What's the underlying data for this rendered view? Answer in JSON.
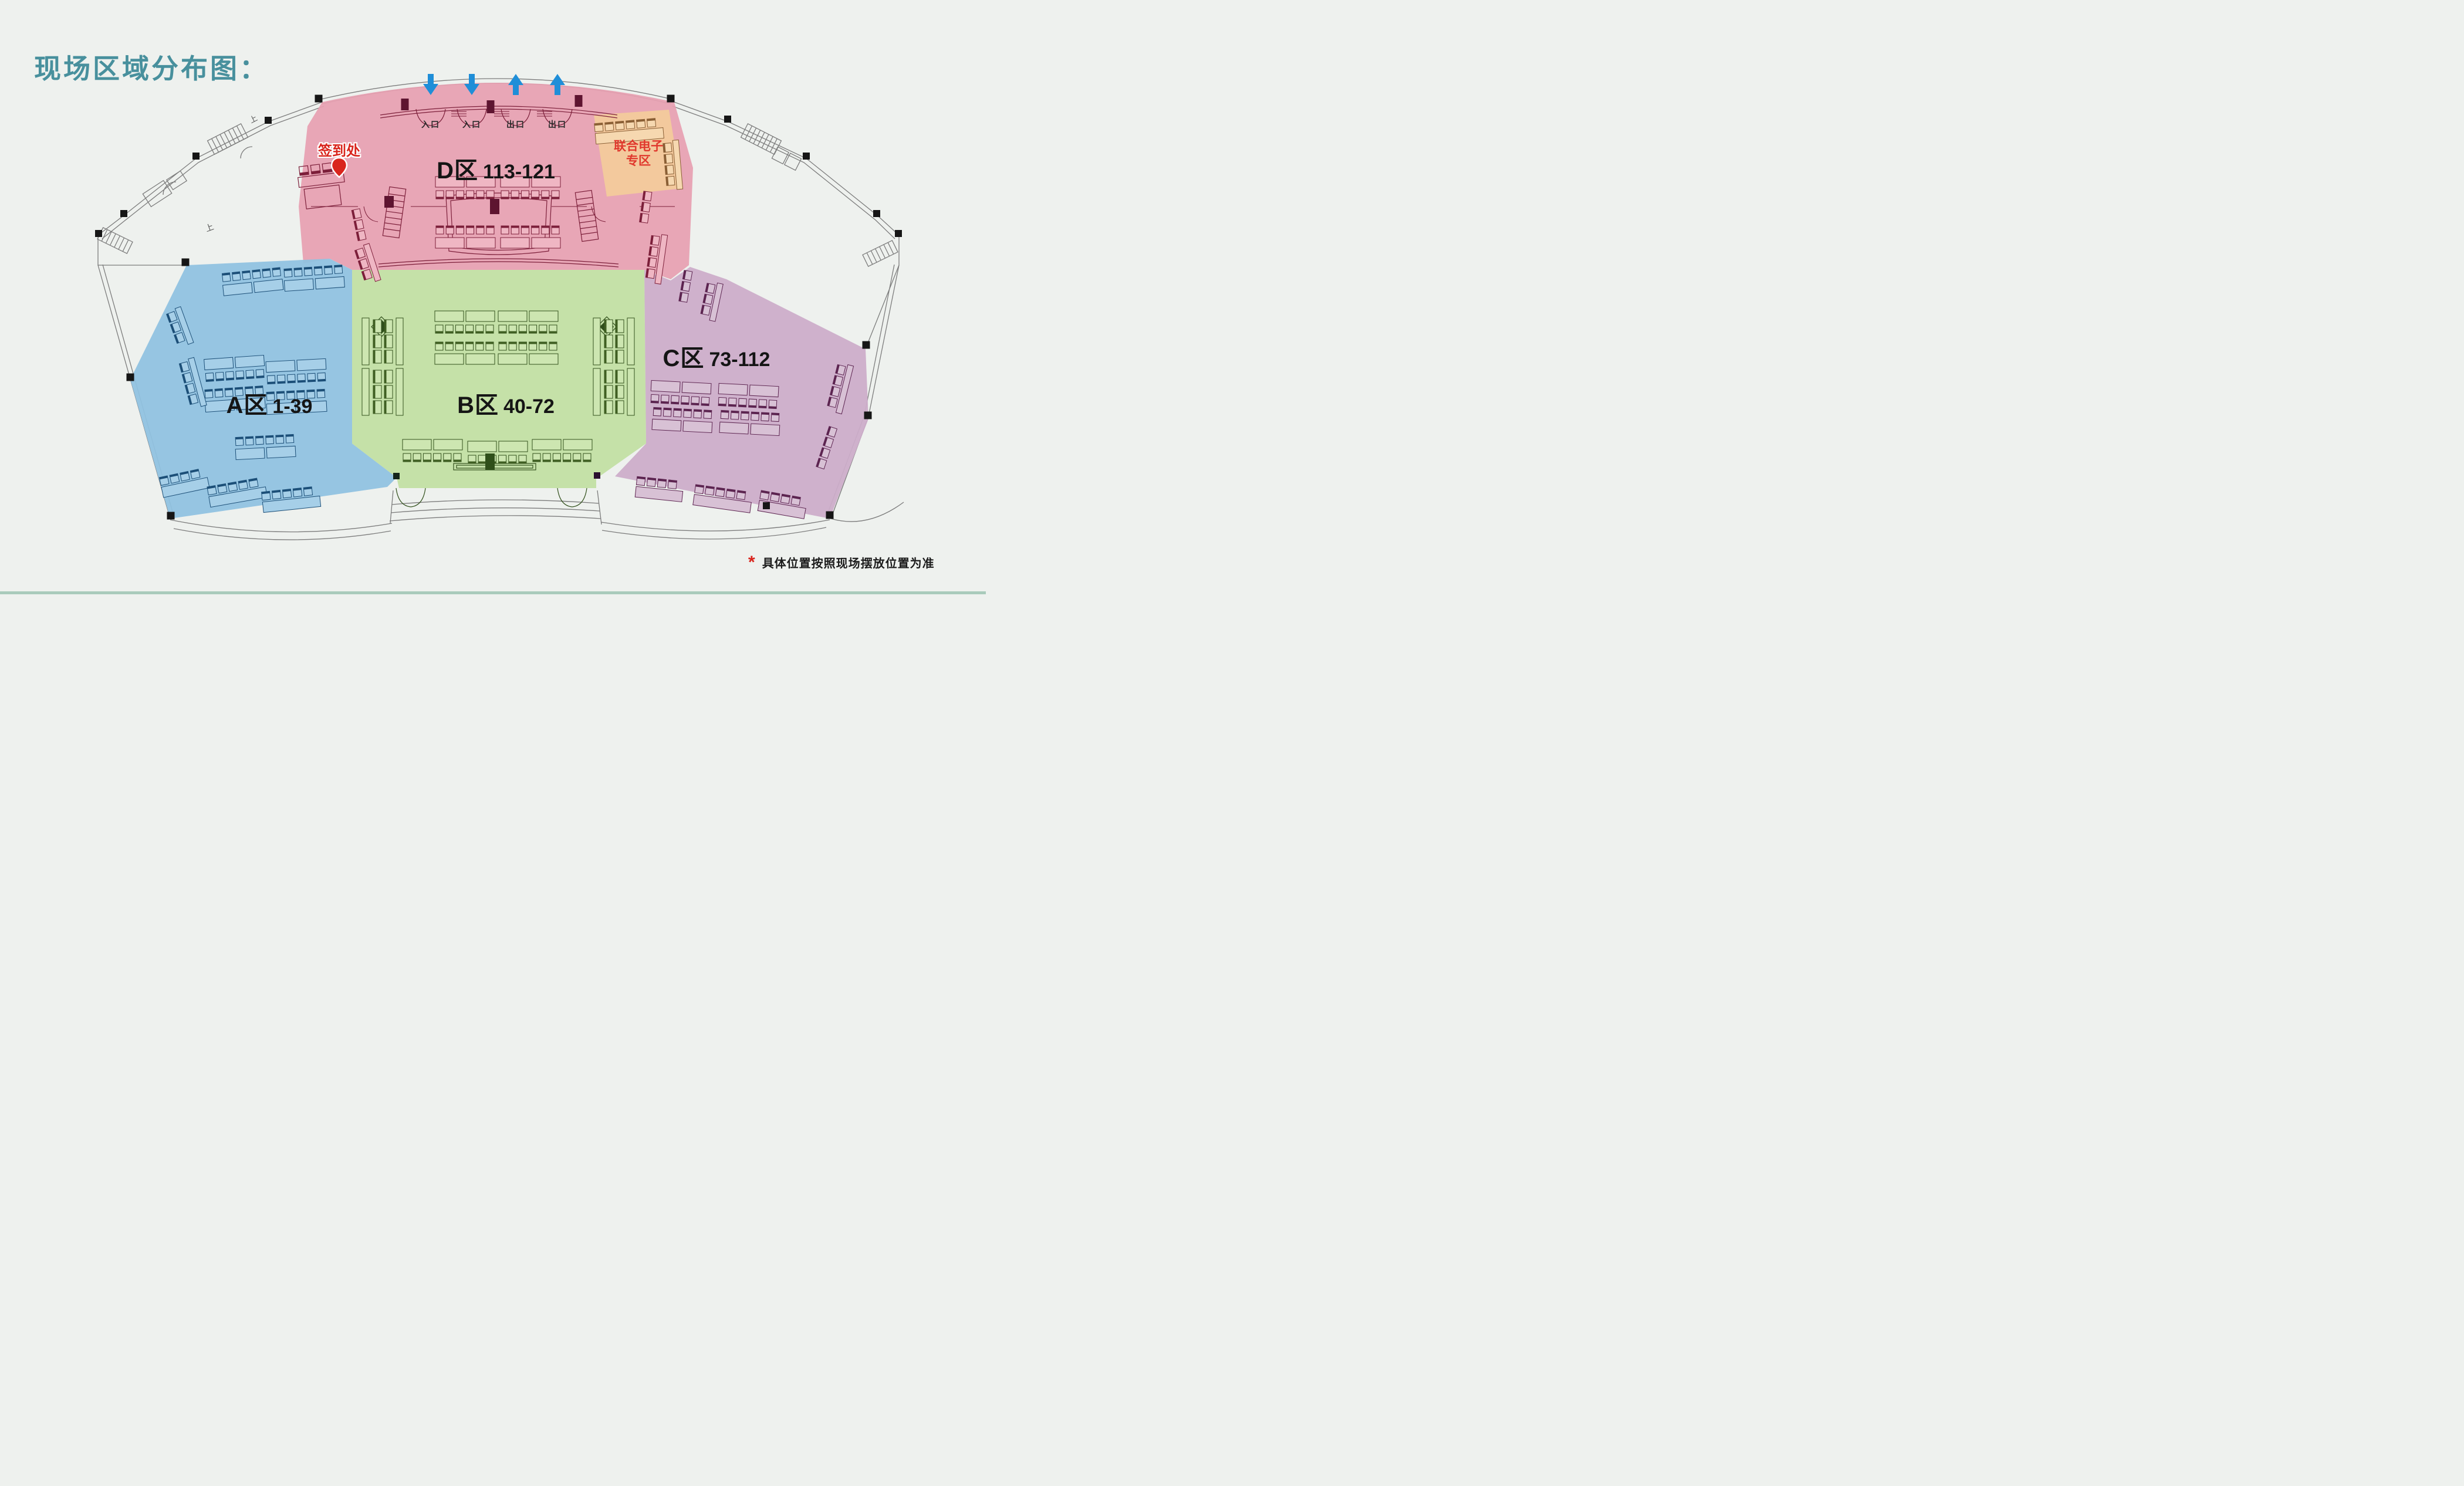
{
  "title": "现场区域分布图：",
  "zones": [
    {
      "id": "A",
      "name": "A区",
      "range": "1-39",
      "color": "#90c2e0"
    },
    {
      "id": "B",
      "name": "B区",
      "range": "40-72",
      "color": "#c2dfa3"
    },
    {
      "id": "C",
      "name": "C区",
      "range": "73-112",
      "color": "#ccadc9"
    },
    {
      "id": "D",
      "name": "D区",
      "range": "113-121",
      "color": "#e7a0b1"
    }
  ],
  "special_zone": {
    "line1": "联合电子",
    "line2": "专区",
    "color": "#f3ca9c",
    "text_color": "#e0382d"
  },
  "signin": {
    "label": "签到处",
    "color": "#d9251d"
  },
  "entrances": [
    {
      "label": "入口",
      "direction": "down"
    },
    {
      "label": "入口",
      "direction": "down"
    },
    {
      "label": "出口",
      "direction": "up"
    },
    {
      "label": "出口",
      "direction": "up"
    }
  ],
  "stairs_label": "上",
  "arrow_color": "#1f8ed8",
  "footnote": {
    "marker": "*",
    "text": "具体位置按照现场摆放位置为准"
  }
}
